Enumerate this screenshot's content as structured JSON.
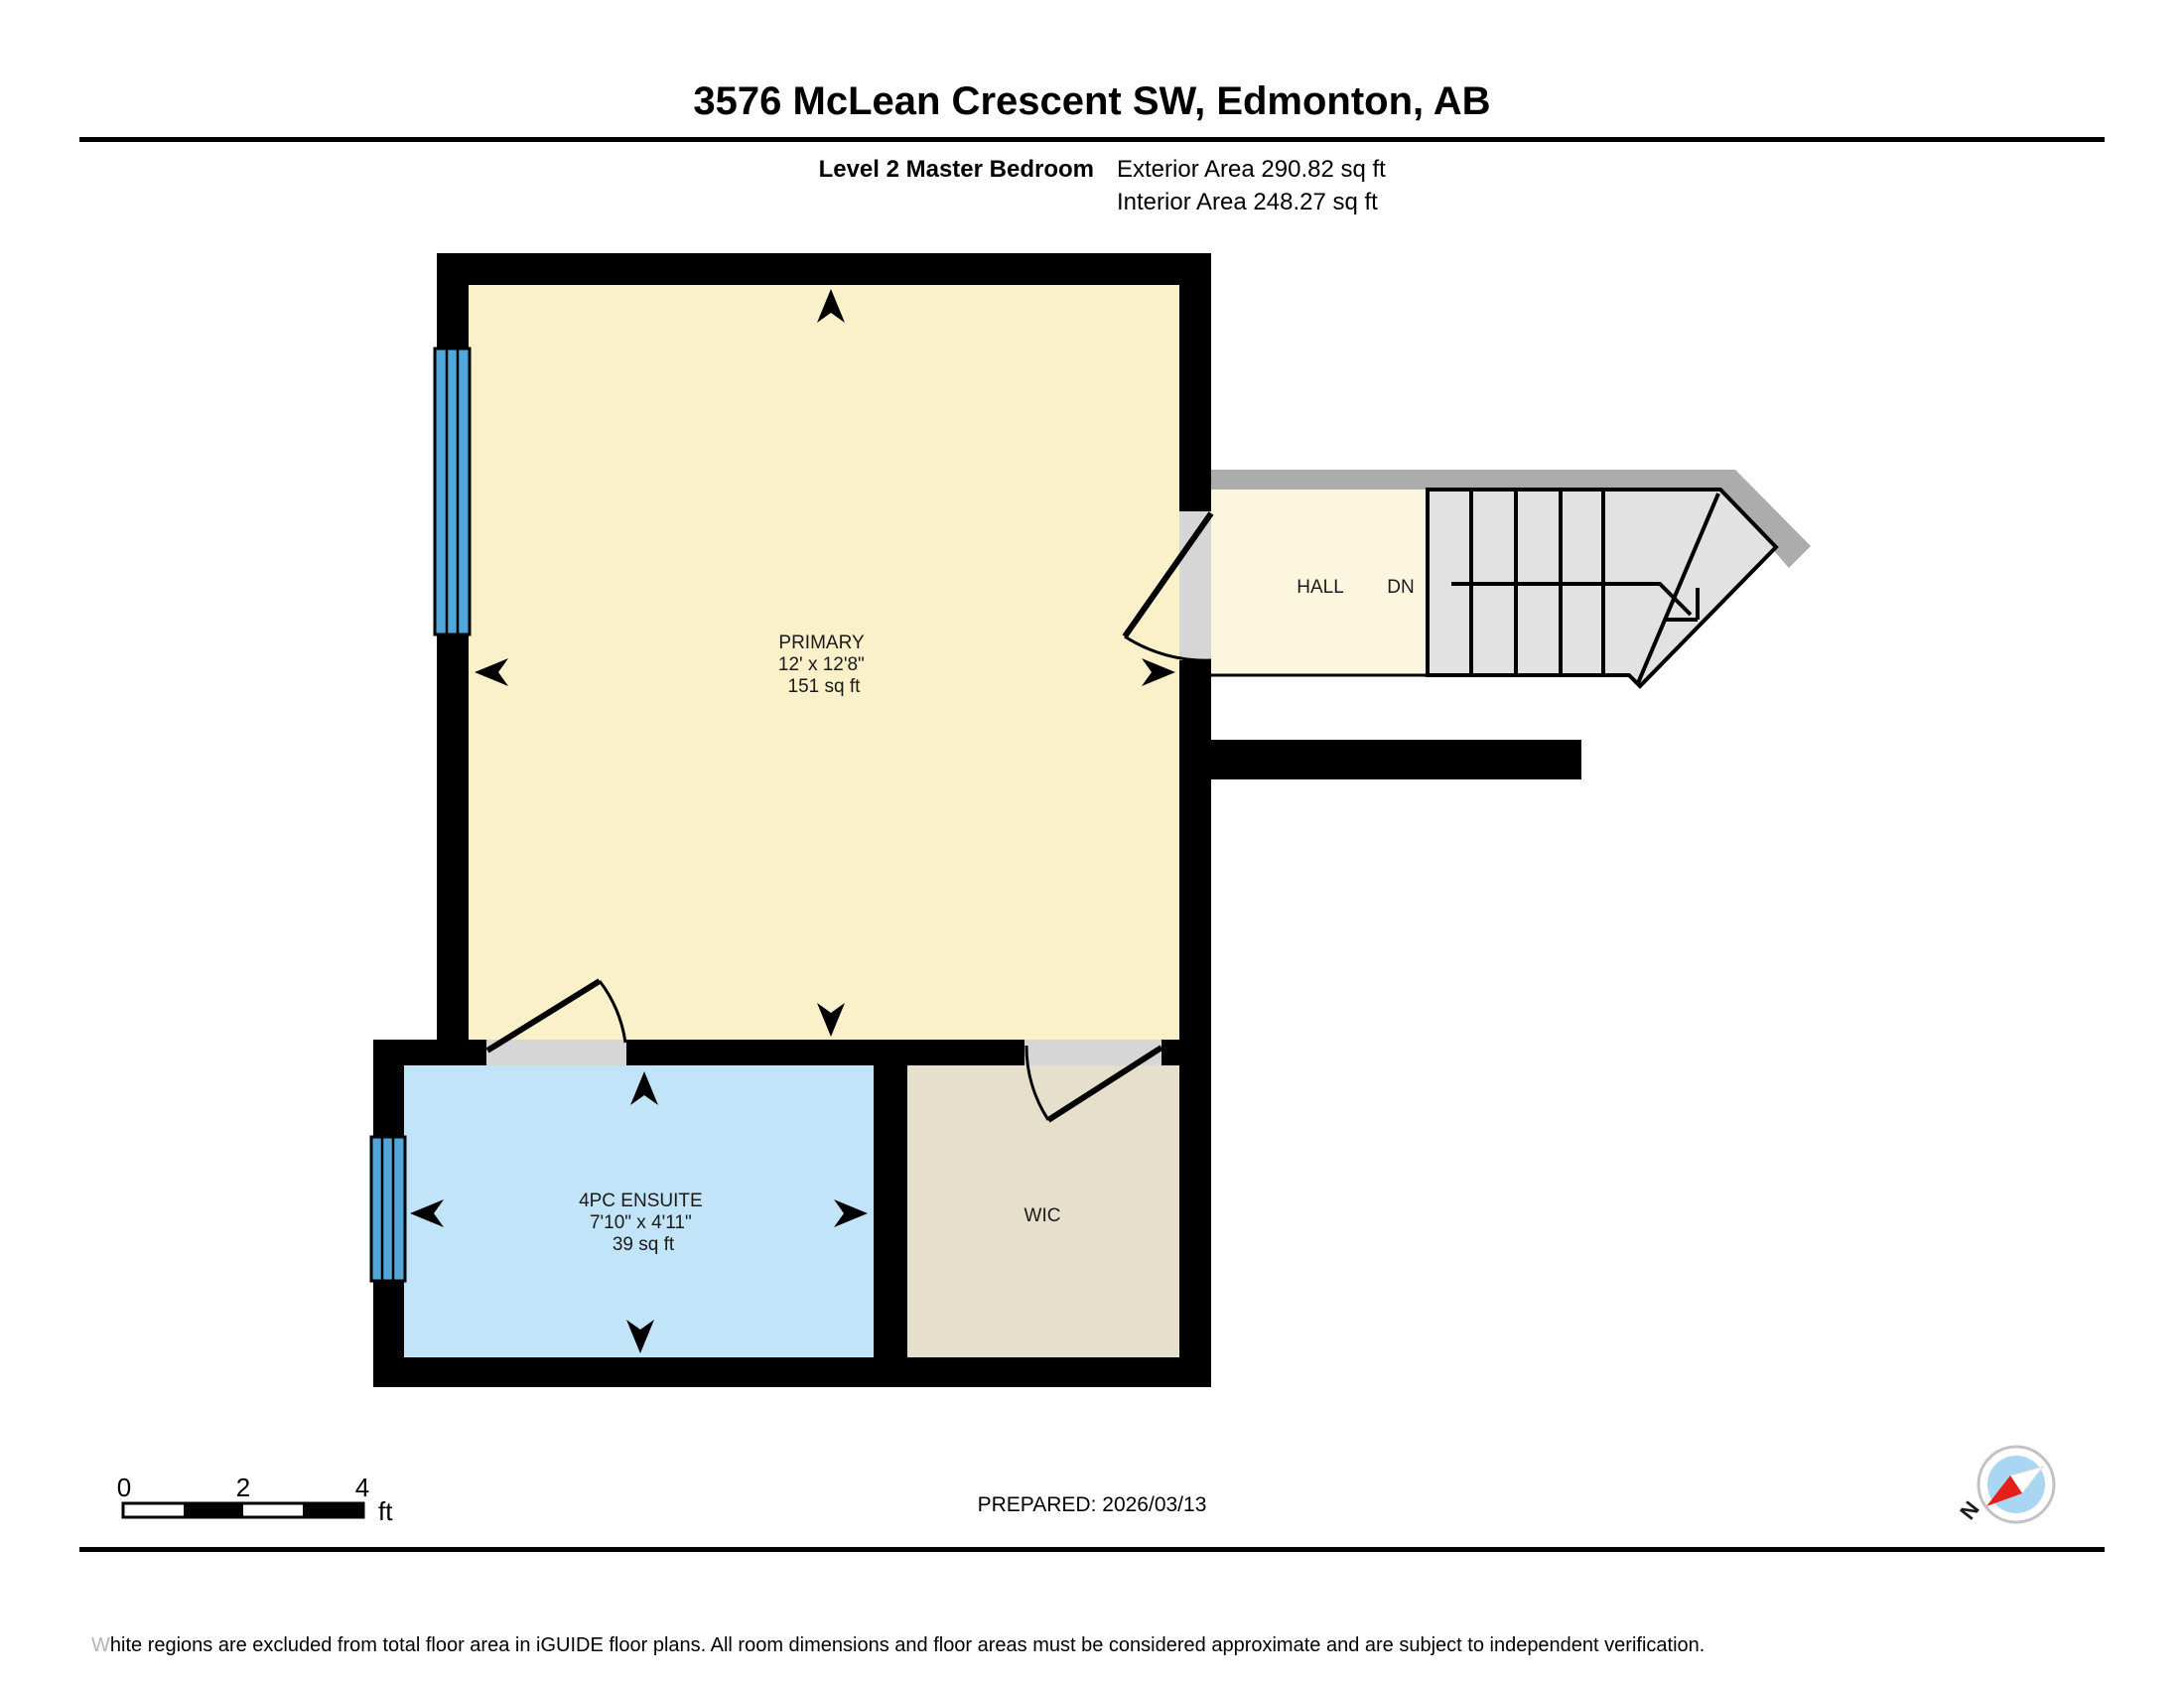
{
  "header": {
    "title": "3576 McLean Crescent SW, Edmonton, AB",
    "level_label": "Level 2 Master Bedroom",
    "exterior_area": "Exterior Area 290.82 sq ft",
    "interior_area": "Interior Area 248.27 sq ft"
  },
  "rooms": {
    "primary": {
      "name": "PRIMARY",
      "dims": "12' x 12'8\"",
      "area": "151 sq ft"
    },
    "ensuite": {
      "name": "4PC ENSUITE",
      "dims": "7'10\" x 4'11\"",
      "area": "39 sq ft"
    },
    "wic": {
      "name": "WIC"
    },
    "hall": {
      "name": "HALL"
    },
    "stairs": {
      "label": "DN"
    }
  },
  "scale_bar": {
    "tick0": "0",
    "tick1": "2",
    "tick2": "4",
    "unit": "ft"
  },
  "footer": {
    "prepared": "PREPARED: 2026/03/13",
    "compass_north": "N",
    "disclaimer_lead": "W",
    "disclaimer_rest": "hite regions are excluded from total floor area in iGUIDE floor plans. All room dimensions and floor areas must be considered approximate and are subject to independent verification."
  },
  "colors": {
    "wall": "#000000",
    "primary_fill": "#FAF0CA",
    "hall_fill": "#FDF6DF",
    "ensuite_fill": "#C2E4F9",
    "wic_fill": "#E6DFCB",
    "stairs_fill": "#E2E2E2",
    "excluded_band": "#ACACAC",
    "threshold": "#D6D6D6",
    "window_blue": "#51A7D9",
    "compass_red": "#E3201B",
    "compass_blue": "#A9D6F2"
  }
}
